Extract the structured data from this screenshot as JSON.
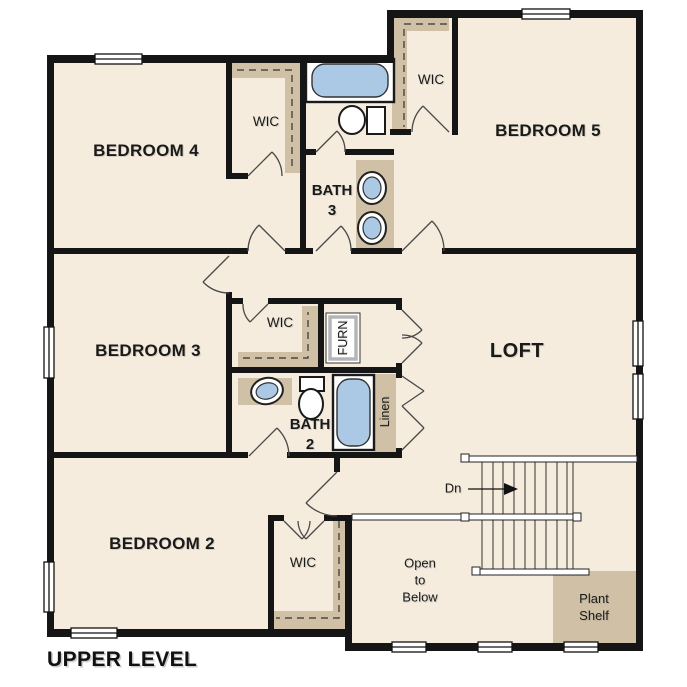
{
  "title": "UPPER LEVEL",
  "rooms": {
    "bedroom4": "BEDROOM 4",
    "bedroom5": "BEDROOM 5",
    "bedroom3": "BEDROOM 3",
    "bedroom2": "BEDROOM 2",
    "loft": "LOFT",
    "bath3": "BATH\n3",
    "bath2": "BATH\n2",
    "wic_bedroom4": "WIC",
    "wic_bedroom5": "WIC",
    "wic_bedroom3": "WIC",
    "wic_bedroom2": "WIC",
    "furnace": "FURN",
    "linen": "Linen",
    "plant_shelf": "Plant\nShelf",
    "open_to_below": "Open\nto\nBelow"
  },
  "stairs": {
    "direction_label": "Dn"
  },
  "fixtures": {
    "bath3": [
      "bathtub",
      "toilet",
      "double-vanity-sinks"
    ],
    "bath2": [
      "vanity-sink",
      "toilet",
      "bathtub"
    ]
  },
  "colors": {
    "floor": "#f5ecdd",
    "wall": "#151515",
    "closet_tan": "#cfc0a6",
    "fixture_blue": "#abc9e5",
    "thin_line": "#4a4a4a"
  }
}
